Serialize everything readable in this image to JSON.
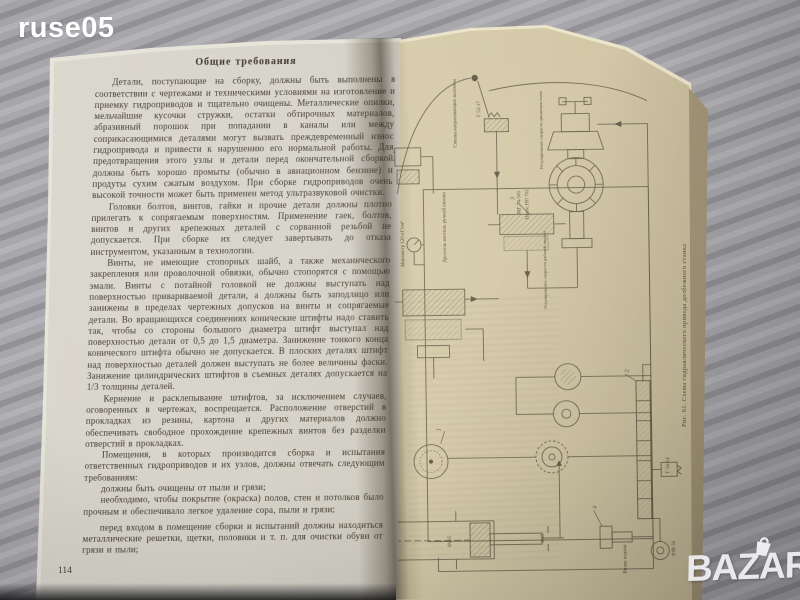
{
  "scene": {
    "watermark_top_left": "ruse05",
    "watermark_bottom_right": "BAZAR"
  },
  "left_page": {
    "heading": "Общие требования",
    "paragraphs": [
      "Детали, поступающие на сборку, должны быть выполнены в соответствии с чертежами и техническими условиями на изготовление и приемку гидроприводов и тщательно очищены. Металлические опилки, мельчайшие кусочки стружки, остатки обтирочных материалов, абразивный порошок при попадании в каналы или между соприкасающимися деталями могут вызвать преждевременный износ гидропривода и привести к нарушению его нормальной работы. Для предотвращения этого узлы и детали перед окончательной сборкой должны быть хорошо промыты (обычно в авиационном бензине) и продуты сухим сжатым воздухом. При сборке гидроприводов очень высокой точности может быть применен метод ультразвуковой очистки.",
      "Головки болтов, винтов, гайки и прочие детали должны плотно прилегать к сопрягаемым поверхностям. Применение гаек, болтов, винтов и других крепежных деталей с сорванной резьбой не допускается. При сборке их следует завертывать до отказа инструментом, указанным в технологии.",
      "Винты, не имеющие стопорных шайб, а также механического закрепления или проволочной обвязки, обычно стопорятся с помощью эмали. Винты с потайной головкой не должны выступать над поверхностью привариваемой детали, а должны быть заподлицо или занижены в пределах чертежных допусков на винты и сопрягаемые детали. Во вращающихся соединениях конические штифты надо ставить так, чтобы со стороны большого диаметра штифт выступал над поверхностью детали от 0,5 до 1,5 диаметра. Занижение тонкого конца конического штифта обычно не допускается. В плоских деталях штифт над поверхностью деталей должен выступать не более величины фаски. Занижение цилиндрических штифтов в съемных деталях допускается на 1/3 толщины деталей.",
      "Кернение и расклепывание штифтов, за исключением случаев, оговоренных в чертежах, воспрещается. Расположение отверстий в прокладках из резины, картона и других материалов должно обеспечивать свободное прохождение крепежных винтов без разделки отверстий в прокладках.",
      "Помещения, в которых производится сборка и испытания ответственных гидроприводов и их узлов, должны отвечать следующим требованиям:",
      "должны быть очищены от пыли и грязи;",
      "необходимо, чтобы покрытие (окраска) полов, стен и потолков было прочным и обеспечивало легкое удаление сора, пыли и грязи;",
      "перед входом в помещение сборки и испытаний должны находиться металлические решетки, щетки, половики и т. п. для очистки обуви от грязи и пыли;"
    ],
    "page_number": "114"
  },
  "right_page": {
    "figure_caption": "Рис. 61. Схема гидравлического привода долбежного станка",
    "diagram_labels": [
      "Смазка направляющих колонны",
      "Г 52-17",
      "Манометр 120 кГ/см²",
      "Дроссель вентиль ручной смазки",
      "МГ 74-500",
      "Насос НП 702",
      "Регулирование скорости движения стола",
      "Регулирование скорости рабочей подачи",
      "Г 34-14",
      "РЗВ 50",
      "Вилка подачи",
      "Ø105",
      "Ø45"
    ],
    "callout_numbers": [
      "3",
      "2",
      "4",
      "1"
    ]
  },
  "colors": {
    "background_surface": "#a7a6ab",
    "left_page_paper": "#d5d2c8",
    "right_page_paper": "#d2c7a6",
    "text_ink": "#423a2e",
    "diagram_ink": "#564c3b",
    "watermark": "#f2f2f4"
  }
}
